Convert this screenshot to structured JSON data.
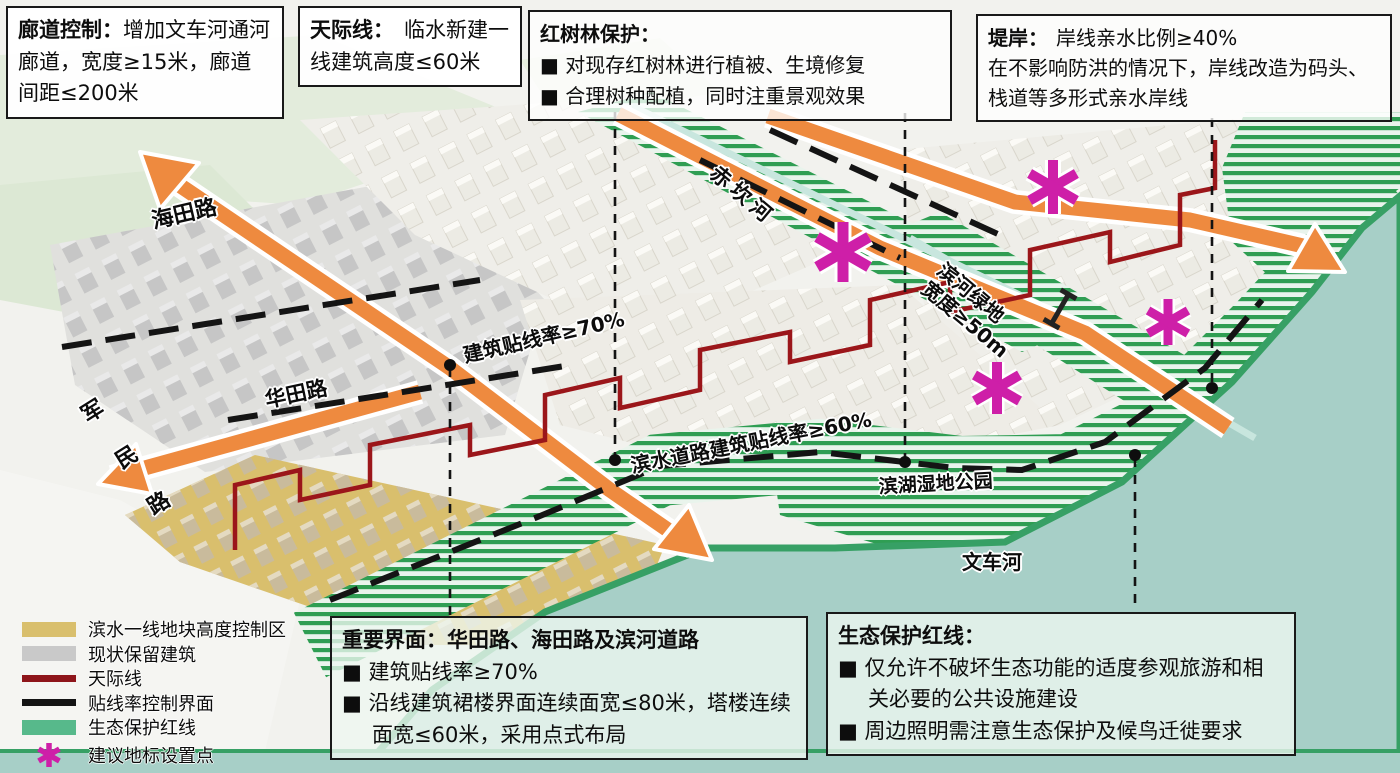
{
  "callouts": {
    "corridor": {
      "title": "廊道控制：",
      "body": "增加文车河通河廊道，宽度≥15米，廊道间距≤200米"
    },
    "skyline": {
      "title": "天际线：",
      "body": "临水新建一线建筑高度≤60米"
    },
    "mangrove": {
      "title": "红树林保护：",
      "bullet1": "■ 对现存红树林进行植被、生境修复",
      "bullet2": "■ 合理树种配植，同时注重景观效果"
    },
    "embankment": {
      "title": "堤岸：",
      "headline": "岸线亲水比例≥40%",
      "body": "在不影响防洪的情况下，岸线改造为码头、栈道等多形式亲水岸线"
    },
    "interface": {
      "title": "重要界面：华田路、海田路及滨河道路",
      "bullet1": "■ 建筑贴线率≥70%",
      "bullet2": "■ 沿线建筑裙楼界面连续面宽≤80米，塔楼连续面宽≤60米，采用点式布局"
    },
    "ecology": {
      "title": "生态保护红线：",
      "bullet1": "■ 仅允许不破坏生态功能的适度参观旅游和相关必要的公共设施建设",
      "bullet2": "■ 周边照明需注意生态保护及候鸟迁徙要求"
    }
  },
  "legend": {
    "items": [
      {
        "label": "滨水一线地块高度控制区",
        "swatch_color": "#d9bf6d",
        "type": "area"
      },
      {
        "label": "现状保留建筑",
        "swatch_color": "#c9c9c9",
        "type": "area"
      },
      {
        "label": "天际线",
        "swatch_color": "#8e151a",
        "type": "line"
      },
      {
        "label": "贴线率控制界面",
        "swatch_color": "#141414",
        "type": "line"
      },
      {
        "label": "生态保护红线",
        "swatch_color": "#57b98b",
        "type": "area"
      },
      {
        "label": "建议地标设置点",
        "swatch_color": "#ce1fa8",
        "type": "marker"
      }
    ]
  },
  "map_labels": {
    "haitian_road": "海田路",
    "chikan_river": "赤坎河",
    "junmin_1": "军",
    "junmin_2": "民",
    "junmin_3": "路",
    "huatian_road": "华田路",
    "setback_70": "建筑贴线率≥70%",
    "greenbelt_line1": "滨河绿地",
    "greenbelt_line2": "宽度≥50m",
    "waterfront_setback_60": "滨水道路建筑贴线率≥60%",
    "wetland_park": "滨湖湿地公园",
    "wenche_river": "文车河"
  },
  "colors": {
    "corridor_orange": "#ee8a3f",
    "skyline_red": "#9b161a",
    "landmark_magenta": "#ce1fa8",
    "eco_green": "#2f9e53",
    "water_teal": "#a7cfc7",
    "height_control_tan": "#d9bf6d",
    "existing_building_gray": "#c9c9c9",
    "interface_black": "#141414"
  }
}
